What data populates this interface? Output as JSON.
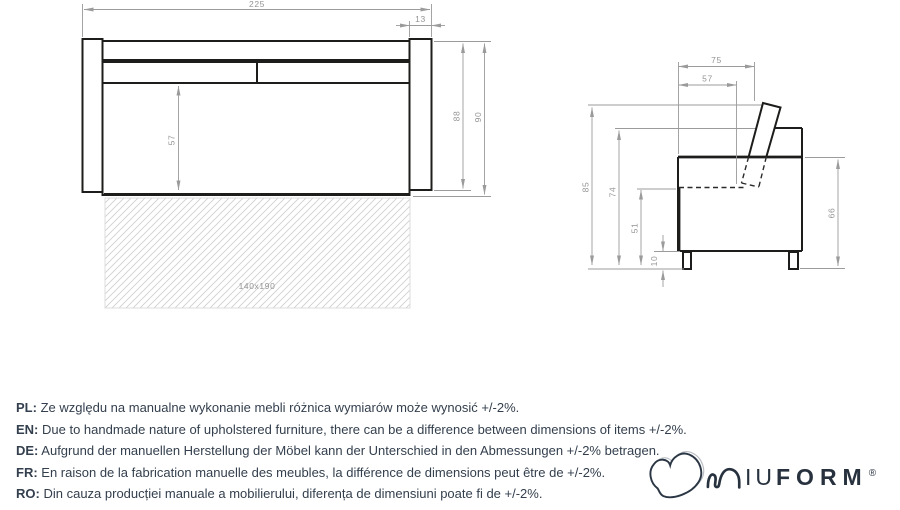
{
  "front_view": {
    "width_total": "225",
    "armrest_width": "13",
    "seat_front_height": "57",
    "height_to_arm_base": "88",
    "height_total": "90",
    "sleeping_area_label": "140x190"
  },
  "side_view": {
    "depth_total": "75",
    "seat_depth": "57",
    "height_total": "85",
    "backrest_height": "74",
    "seat_level_height": "51",
    "leg_height": "10",
    "side_height": "66"
  },
  "notes": [
    {
      "label": "PL:",
      "text": "Ze względu na manualne wykonanie mebli różnica wymiarów może wynosić +/-2%."
    },
    {
      "label": "EN:",
      "text": "Due to handmade nature of upholstered furniture, there can be a difference between dimensions of items +/-2%."
    },
    {
      "label": "DE:",
      "text": "Aufgrund der manuellen Herstellung der Möbel kann der Unterschied in den Abmessungen +/-2% betragen."
    },
    {
      "label": "FR:",
      "text": "En raison de la fabrication manuelle des meubles, la différence de dimensions peut être de +/-2%."
    },
    {
      "label": "RO:",
      "text": "Din cauza producției manuale a mobilierului, diferența de dimensiuni poate fi de +/-2%."
    }
  ],
  "logo": {
    "brand": "MIUFORM",
    "wordmark_thin": "IU",
    "wordmark_bold": "FORM",
    "registered_mark": "®"
  },
  "colors": {
    "outline": "#1d1d1b",
    "dimension_line": "#9b9b9b",
    "hatch_line": "#d0d0d0",
    "note_text": "#333f4d",
    "logo_navy": "#28323f"
  }
}
